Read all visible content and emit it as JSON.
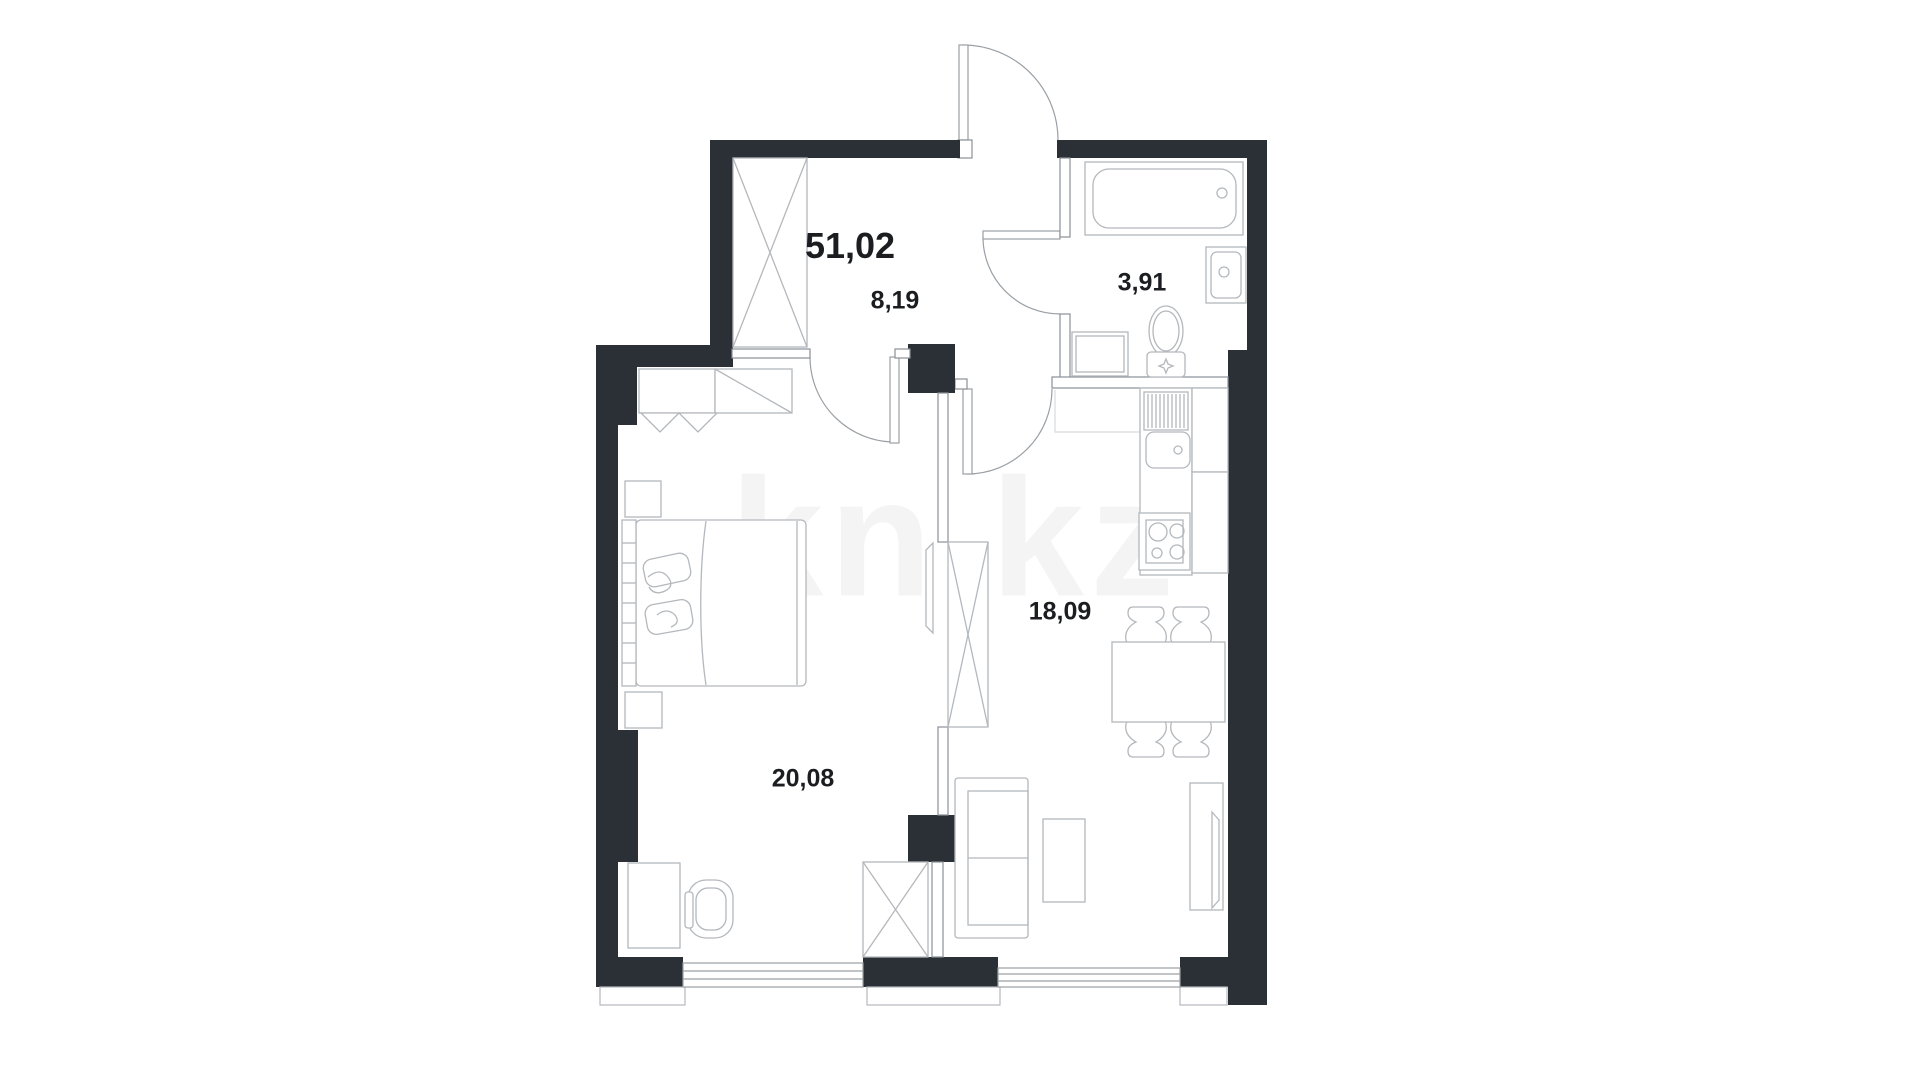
{
  "plan": {
    "total_area": "51,02",
    "watermark": "kn.kz",
    "rooms": [
      {
        "id": "hallway",
        "name": "hallway",
        "area": "8,19"
      },
      {
        "id": "bathroom",
        "name": "bathroom",
        "area": "3,91"
      },
      {
        "id": "kitchen-living",
        "name": "kitchen-living",
        "area": "18,09"
      },
      {
        "id": "bedroom",
        "name": "bedroom",
        "area": "20,08"
      }
    ],
    "colors": {
      "wall": "#2b3036",
      "interior_wall_line": "#8a9096",
      "furniture_line": "#b4b8bc",
      "door_line": "#9aa0a5",
      "window_line": "#9aa0a5",
      "zone_line": "#d8dadc",
      "text": "#1b1d20",
      "watermark": "rgba(43,48,54,0.05)"
    }
  }
}
